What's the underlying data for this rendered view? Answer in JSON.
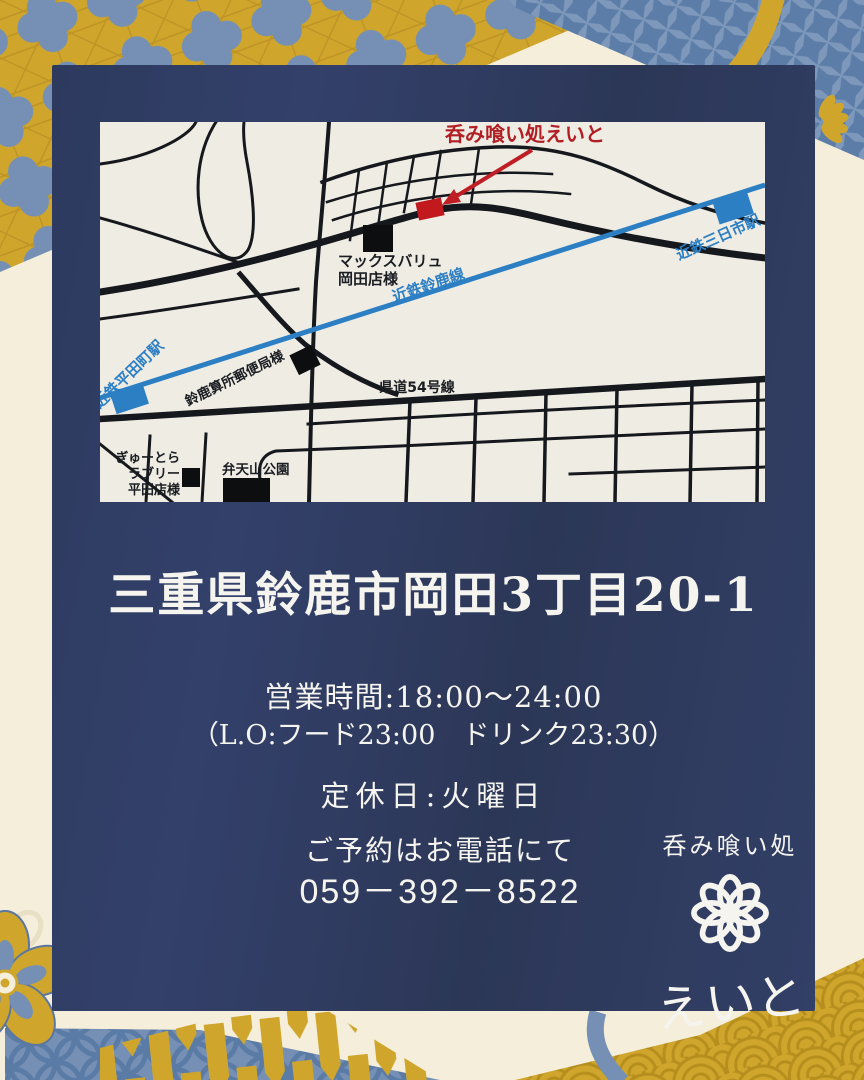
{
  "theme": {
    "bg": "#f4eedb",
    "card_navy": "#303c62",
    "gold": "#cfa62b",
    "steel_blue": "#7590b4",
    "rail_blue": "#2d7fc4",
    "accent_red": "#c0242b",
    "map_bg": "#efece4",
    "ink": "#15181c"
  },
  "map": {
    "shop_callout": "呑み喰い処えいと",
    "maxvalu_line1": "マックスバリュ",
    "maxvalu_line2": "岡田店様",
    "post_office": "鈴鹿算所郵便局様",
    "route": "県道54号線",
    "rail_line": "近鉄鈴鹿線",
    "station_hirata": "近鉄平田町駅",
    "station_mikkaichi": "近鉄三日市駅",
    "gyutora_line1": "ぎゅーとら",
    "gyutora_line2": "ラブリー",
    "gyutora_line3": "平田店様",
    "park": "弁天山公園"
  },
  "info": {
    "address": "三重県鈴鹿市岡田3丁目20-1",
    "hours": "営業時間:18:00～24:00",
    "last_order": "（L.O:フード23:00　ドリンク23:30）",
    "closed": "定休日:火曜日",
    "reservation": "ご予約はお電話にて",
    "phone": "059－392－8522"
  },
  "logo": {
    "tagline": "呑み喰い処",
    "name": "えいと"
  }
}
